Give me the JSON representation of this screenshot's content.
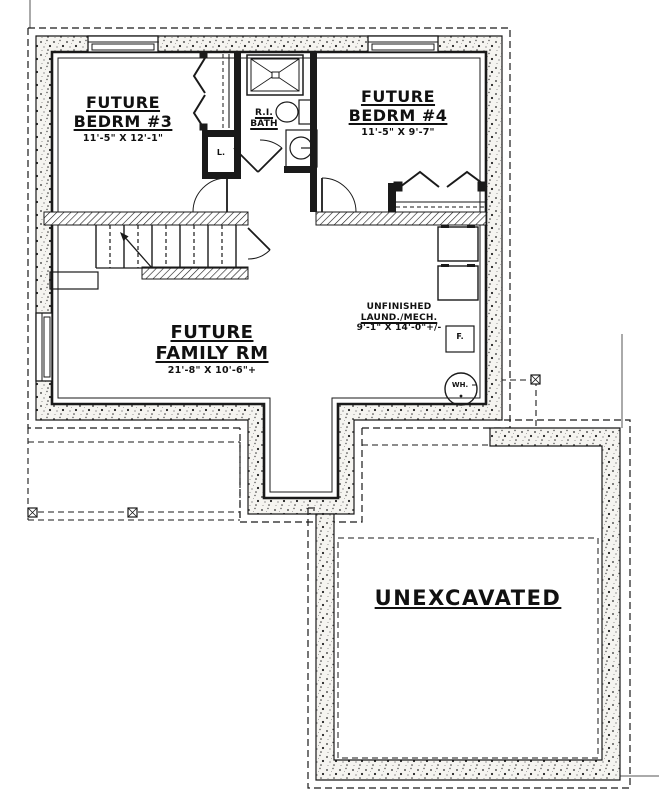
{
  "rooms": {
    "bedrm3": {
      "line1": "FUTURE",
      "line2": "BEDRM #3",
      "dims": "11'-5\" X 12'-1\""
    },
    "bedrm4": {
      "line1": "FUTURE",
      "line2": "BEDRM #4",
      "dims": "11'-5\" X 9'-7\""
    },
    "family": {
      "line1": "FUTURE",
      "line2": "FAMILY RM",
      "dims": "21'-8\" X 10'-6\"+"
    },
    "laundry": {
      "line1": "UNFINISHED",
      "line2": "LAUND./MECH.",
      "dims": "9'-1\" X 14'-0\"+/-"
    },
    "bath": {
      "line1": "R.I.",
      "line2": "BATH"
    },
    "unexcavated": {
      "line1": "UNEXCAVATED"
    }
  },
  "fixtures": {
    "linen_closet": "L.",
    "furnace": "F.",
    "water_heater": "WH."
  },
  "colors": {
    "line": "#1a1a1a",
    "paper": "#ffffff"
  }
}
